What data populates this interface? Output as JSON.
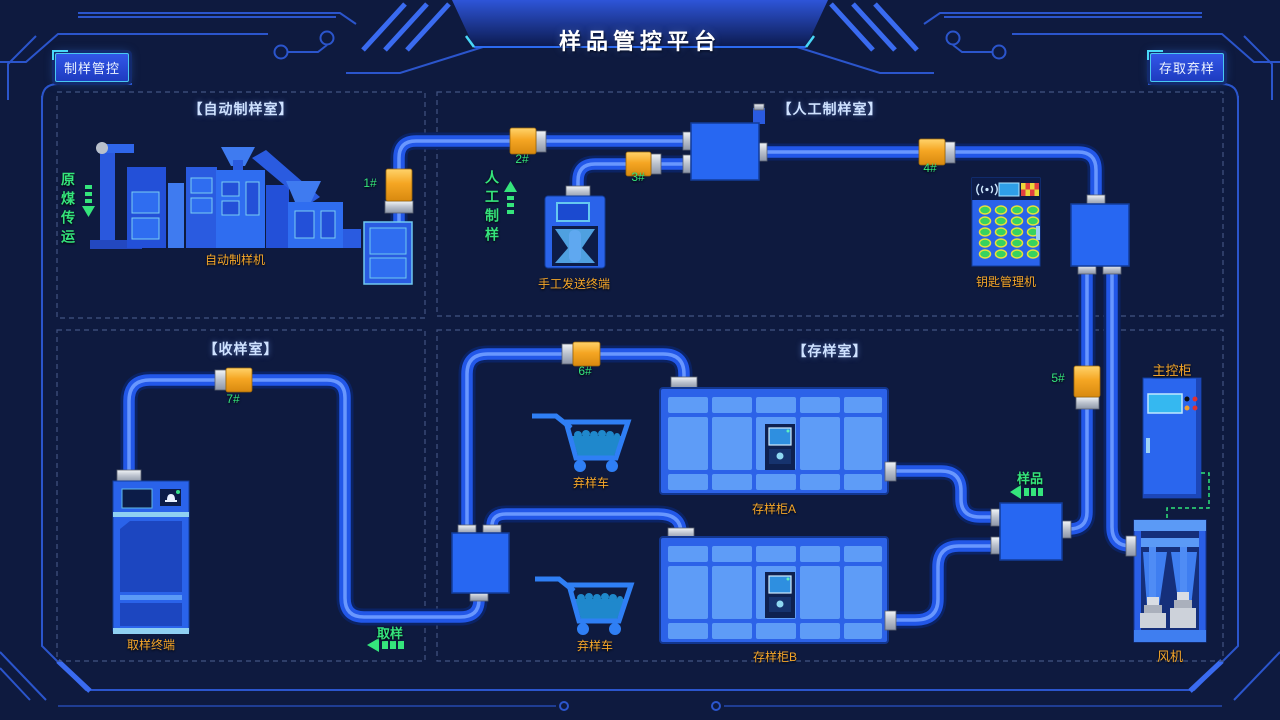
{
  "header": {
    "title": "样品管控平台",
    "left_button": "制样管控",
    "right_button": "存取弃样"
  },
  "rooms": {
    "auto": "【自动制样室】",
    "manual": "【人工制样室】",
    "receive": "【收样室】",
    "storage": "【存样室】"
  },
  "valves": [
    "1#",
    "2#",
    "3#",
    "4#",
    "5#",
    "6#",
    "7#"
  ],
  "flow": {
    "raw_coal": "原煤传运",
    "manual_prep": "人工制样",
    "sample": "样品",
    "sampling": "取样"
  },
  "equipment": {
    "auto_sampler": "自动制样机",
    "manual_send_terminal": "手工发送终端",
    "key_manager": "钥匙管理机",
    "sampling_terminal": "取样终端",
    "discard_cart_a": "弃样车",
    "discard_cart_b": "弃样车",
    "storage_cabinet_a": "存样柜A",
    "storage_cabinet_b": "存样柜B",
    "main_control_cabinet": "主控柜",
    "fan": "风机"
  },
  "colors": {
    "background": "#0e1a3f",
    "pipe": "#2257e8",
    "valve_orange": "#f0a323",
    "accent_green": "#35e57c",
    "accent_orange": "#f5a62a",
    "accent_cyan": "#49c8f0",
    "room_label": "#cfe2ff",
    "frame_blue": "#2b55cc"
  },
  "icons": {
    "wifi": "signal-arcs",
    "bell": "bell",
    "checker": "checker-flag",
    "flow_arrow": "dashed-arrow"
  }
}
